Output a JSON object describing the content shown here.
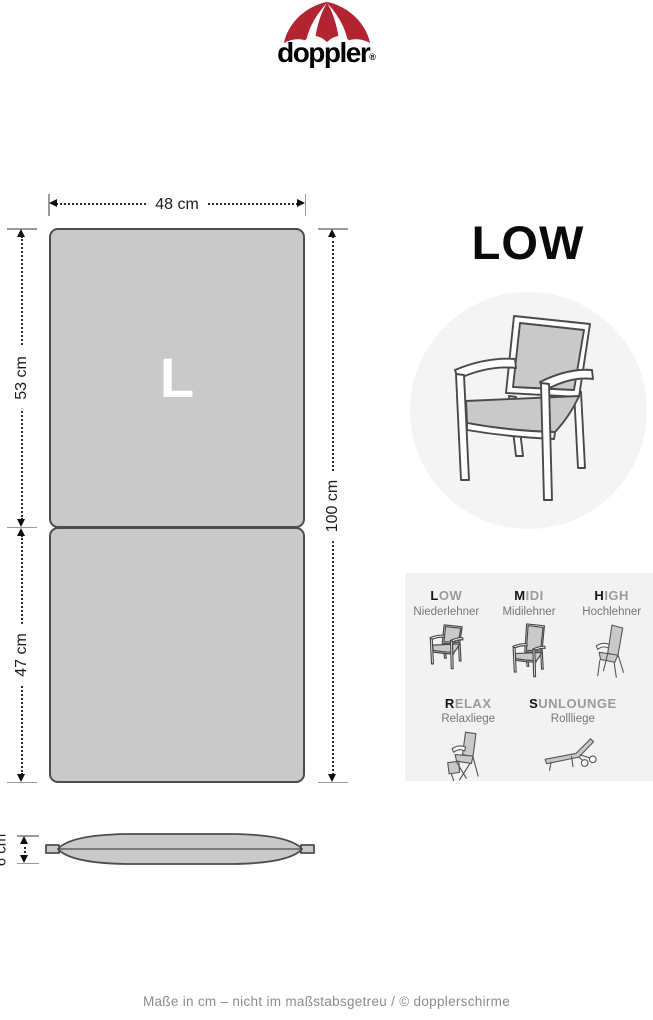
{
  "brand": {
    "wordmark": "doppler",
    "registered": "®"
  },
  "diagram": {
    "size_letter": "L",
    "width_label": "48 cm",
    "upper_height_label": "53 cm",
    "lower_height_label": "47 cm",
    "total_height_label": "100 cm",
    "thickness_label": "6 cm"
  },
  "product": {
    "type_title": "LOW"
  },
  "type_panel": {
    "items": [
      {
        "first": "L",
        "rest": "OW",
        "subtitle": "Niederlehner"
      },
      {
        "first": "M",
        "rest": "IDI",
        "subtitle": "Midilehner"
      },
      {
        "first": "H",
        "rest": "IGH",
        "subtitle": "Hochlehner"
      },
      {
        "first": "R",
        "rest": "ELAX",
        "subtitle": "Relaxliege"
      },
      {
        "first": "S",
        "rest": "UNLOUNGE",
        "subtitle": "Rollliege"
      }
    ]
  },
  "footer": {
    "note": "Maße in cm – nicht im maßstabsgetreu  / © dopplerschirme"
  },
  "colors": {
    "brand_red": "#b22432",
    "cushion_fill": "#c9c9c9",
    "cushion_outline": "#4d4d4d",
    "panel_bg": "#f2f2f2",
    "circle_bg": "#f4f4f4",
    "muted_text": "#9b9b9b"
  }
}
